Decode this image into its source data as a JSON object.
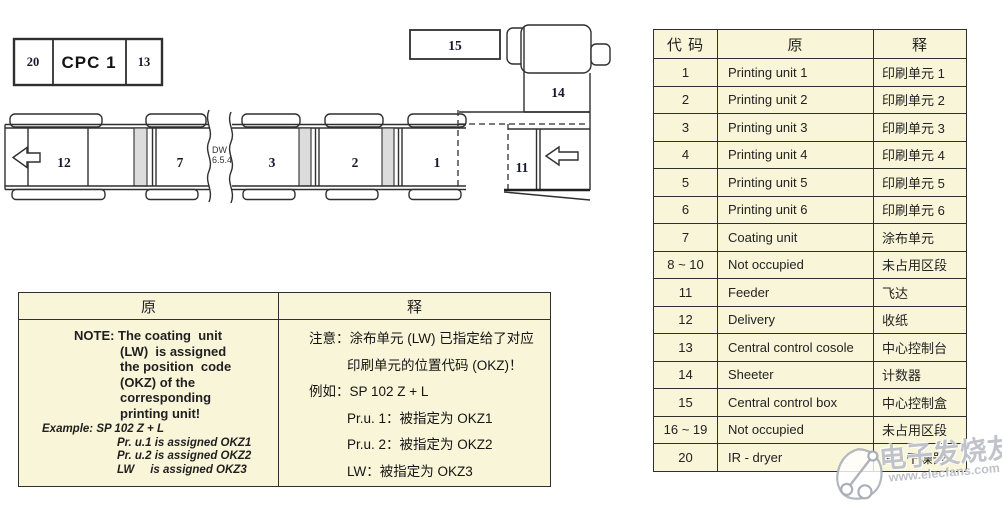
{
  "cpc_panel": {
    "slot_left": "20",
    "title": "CPC 1",
    "slot_right": "13"
  },
  "diagram": {
    "labels": {
      "delivery": "12",
      "coating": "7",
      "unit3": "3",
      "unit2": "2",
      "unit1": "1",
      "feeder": "11",
      "sheeter": "14",
      "control_box": "15",
      "dw_line1": "DW",
      "dw_line2": "6.5.4"
    }
  },
  "note_table": {
    "header_source": "原",
    "header_translation": "释",
    "source_note_lines": [
      "NOTE: The coating  unit",
      "(LW)  is assigned",
      "the position  code",
      "(OKZ) of the",
      "corresponding",
      "printing unit!"
    ],
    "source_example_lines": [
      "Example: SP 102 Z + L",
      "Pr. u.1 is assigned OKZ1",
      "Pr. u.2 is assigned OKZ2",
      "LW     is assigned OKZ3"
    ],
    "translation_lines": [
      "注意：涂布单元 (LW) 已指定给了对应",
      "印刷单元的位置代码 (OKZ)！",
      "例如：SP 102 Z + L",
      "Pr.u. 1：被指定为 OKZ1",
      "Pr.u. 2：被指定为 OKZ2",
      "LW：被指定为 OKZ3"
    ]
  },
  "code_table": {
    "headers": {
      "code": "代 码",
      "source": "原",
      "translation": "释"
    },
    "rows": [
      {
        "code": "1",
        "source": "Printing unit 1",
        "translation": "印刷单元 1"
      },
      {
        "code": "2",
        "source": "Printing unit 2",
        "translation": "印刷单元 2"
      },
      {
        "code": "3",
        "source": "Printing unit 3",
        "translation": "印刷单元 3"
      },
      {
        "code": "4",
        "source": "Printing unit 4",
        "translation": "印刷单元 4"
      },
      {
        "code": "5",
        "source": "Printing unit 5",
        "translation": "印刷单元 5"
      },
      {
        "code": "6",
        "source": "Printing unit 6",
        "translation": "印刷单元 6"
      },
      {
        "code": "7",
        "source": "Coating unit",
        "translation": "涂布单元"
      },
      {
        "code": "8 ~ 10",
        "source": "Not occupied",
        "translation": "未占用区段"
      },
      {
        "code": "11",
        "source": "Feeder",
        "translation": "飞达"
      },
      {
        "code": "12",
        "source": "Delivery",
        "translation": "收纸"
      },
      {
        "code": "13",
        "source": "Central control cosole",
        "translation": "中心控制台"
      },
      {
        "code": "14",
        "source": "Sheeter",
        "translation": "计数器"
      },
      {
        "code": "15",
        "source": "Central control box",
        "translation": "中心控制盒"
      },
      {
        "code": "16 ~ 19",
        "source": "Not occupied",
        "translation": "未占用区段"
      },
      {
        "code": "20",
        "source": "IR - dryer",
        "translation": "IR - 干燥器"
      }
    ]
  },
  "watermark": {
    "brand": "电子发烧友",
    "site": "www.elecfans.com"
  },
  "colors": {
    "table_bg": "#f9f5d8",
    "border": "#2f2f2f",
    "band_fill": "#dcdcdc"
  }
}
